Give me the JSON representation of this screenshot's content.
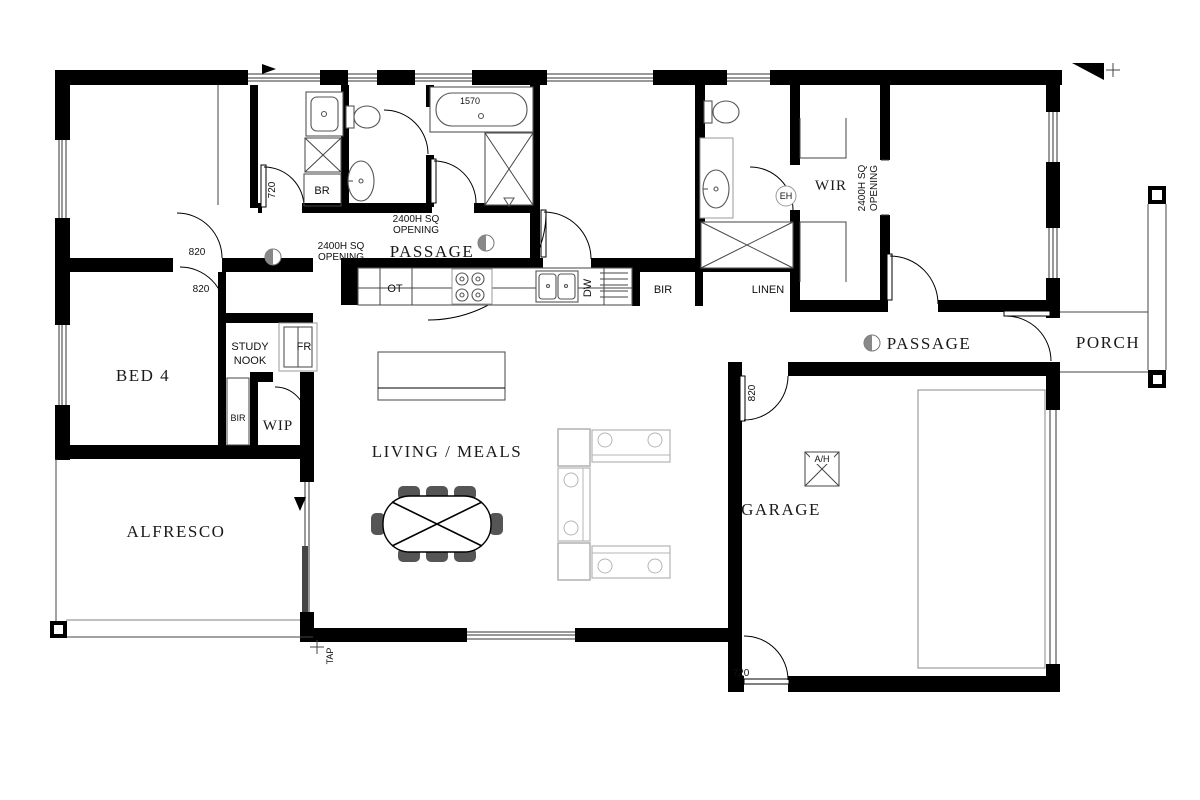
{
  "plan": {
    "rooms": {
      "bed4": "BED 4",
      "alfresco": "ALFRESCO",
      "living_meals": "LIVING / MEALS",
      "garage": "GARAGE",
      "passage_top": "PASSAGE",
      "passage_right": "PASSAGE",
      "porch": "PORCH",
      "wir": "WIR",
      "wip": "WIP",
      "study_nook_line1": "STUDY",
      "study_nook_line2": "NOOK"
    },
    "closets": {
      "bir_bed2": "BIR",
      "bir_bed4": "BIR",
      "linen": "LINEN",
      "broom": "BR"
    },
    "appliances": {
      "oven_tower": "OT",
      "dishwasher": "DW",
      "fridge": "FR",
      "air_handler": "A/H",
      "hot_water": "EH"
    },
    "fittings": {
      "tap": "TAP"
    },
    "dimensions": {
      "bath": "1570",
      "laundry_door": "720",
      "garage_rear_door": "720",
      "passage_door_upper": "820",
      "passage_door_lower": "820",
      "garage_entry_door": "820"
    },
    "openings": {
      "line1": "2400H SQ",
      "line2": "OPENING"
    },
    "colors": {
      "wall": "#000000",
      "slab_edge": "#aaaaaa",
      "furniture_outline": "#b5b5b5",
      "fixture_outline": "#555555"
    }
  }
}
